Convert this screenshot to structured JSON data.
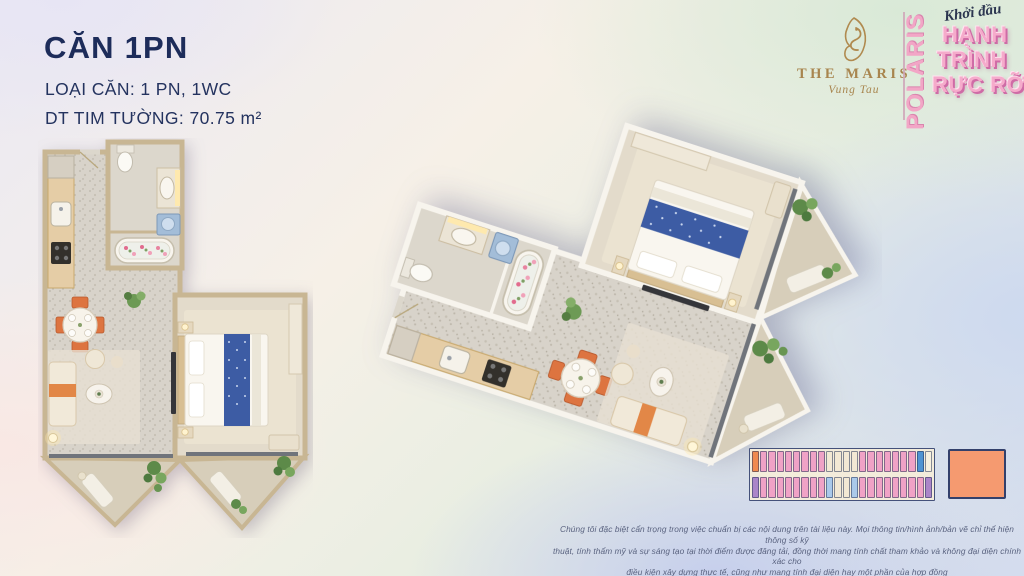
{
  "unit": {
    "title": "CĂN 1PN",
    "type_line": "LOẠI CĂN: 1 PN, 1WC",
    "area_line": "DT TIM TƯỜNG: 70.75 m²"
  },
  "brand": {
    "name": "THE MARIS",
    "location": "Vung Tau",
    "campaign_vertical": "POLARIS",
    "campaign_script": "Khởi đầu",
    "campaign_lines": [
      "HẠNH",
      "TRÌNH",
      "RỰC RỠ"
    ]
  },
  "key_plan": {
    "palette": {
      "O": "#ef8a4e",
      "P": "#f0a2c6",
      "B": "#4f93d2",
      "U": "#ab85c8",
      "C": "#f2e8d4",
      "L": "#aac9ea",
      "W": "#f6f0e0"
    },
    "rows": [
      {
        "cells": [
          "O",
          "P",
          "P",
          "P",
          "P",
          "P",
          "P",
          "P",
          "P",
          "C",
          "C",
          "C",
          "C",
          "P",
          "P",
          "P",
          "P",
          "P",
          "P",
          "P",
          "B",
          "W"
        ]
      },
      {
        "cells": [
          "U",
          "P",
          "P",
          "P",
          "P",
          "P",
          "P",
          "P",
          "P",
          "L",
          "C",
          "C",
          "L",
          "P",
          "P",
          "P",
          "P",
          "P",
          "P",
          "P",
          "P",
          "U"
        ]
      }
    ],
    "legend_color": "#f59a70"
  },
  "disclaimer": {
    "line1": "Chúng tôi đặc biệt cẩn trọng trong việc chuẩn bị các nội dung trên tài liệu này. Mọi thông tin/hình ảnh/bản vẽ chỉ thể hiện thông số kỹ",
    "line2": "thuật, tính thẩm mỹ và sự sáng tạo tại thời điểm được đăng tải, đồng thời mang tính chất tham khảo và không đại diện chính xác cho",
    "line3": "điều kiện xây dựng thực tế, cũng như mang tính đại diện hay một phần của hợp đồng"
  },
  "colors": {
    "navy": "#1d2c5a",
    "gold": "#a8854e",
    "pink": "#f5abcb",
    "pink_shadow": "#cf6ba6",
    "wall_2d": "#c8b693",
    "wall_3d": "#f7f4ed"
  }
}
